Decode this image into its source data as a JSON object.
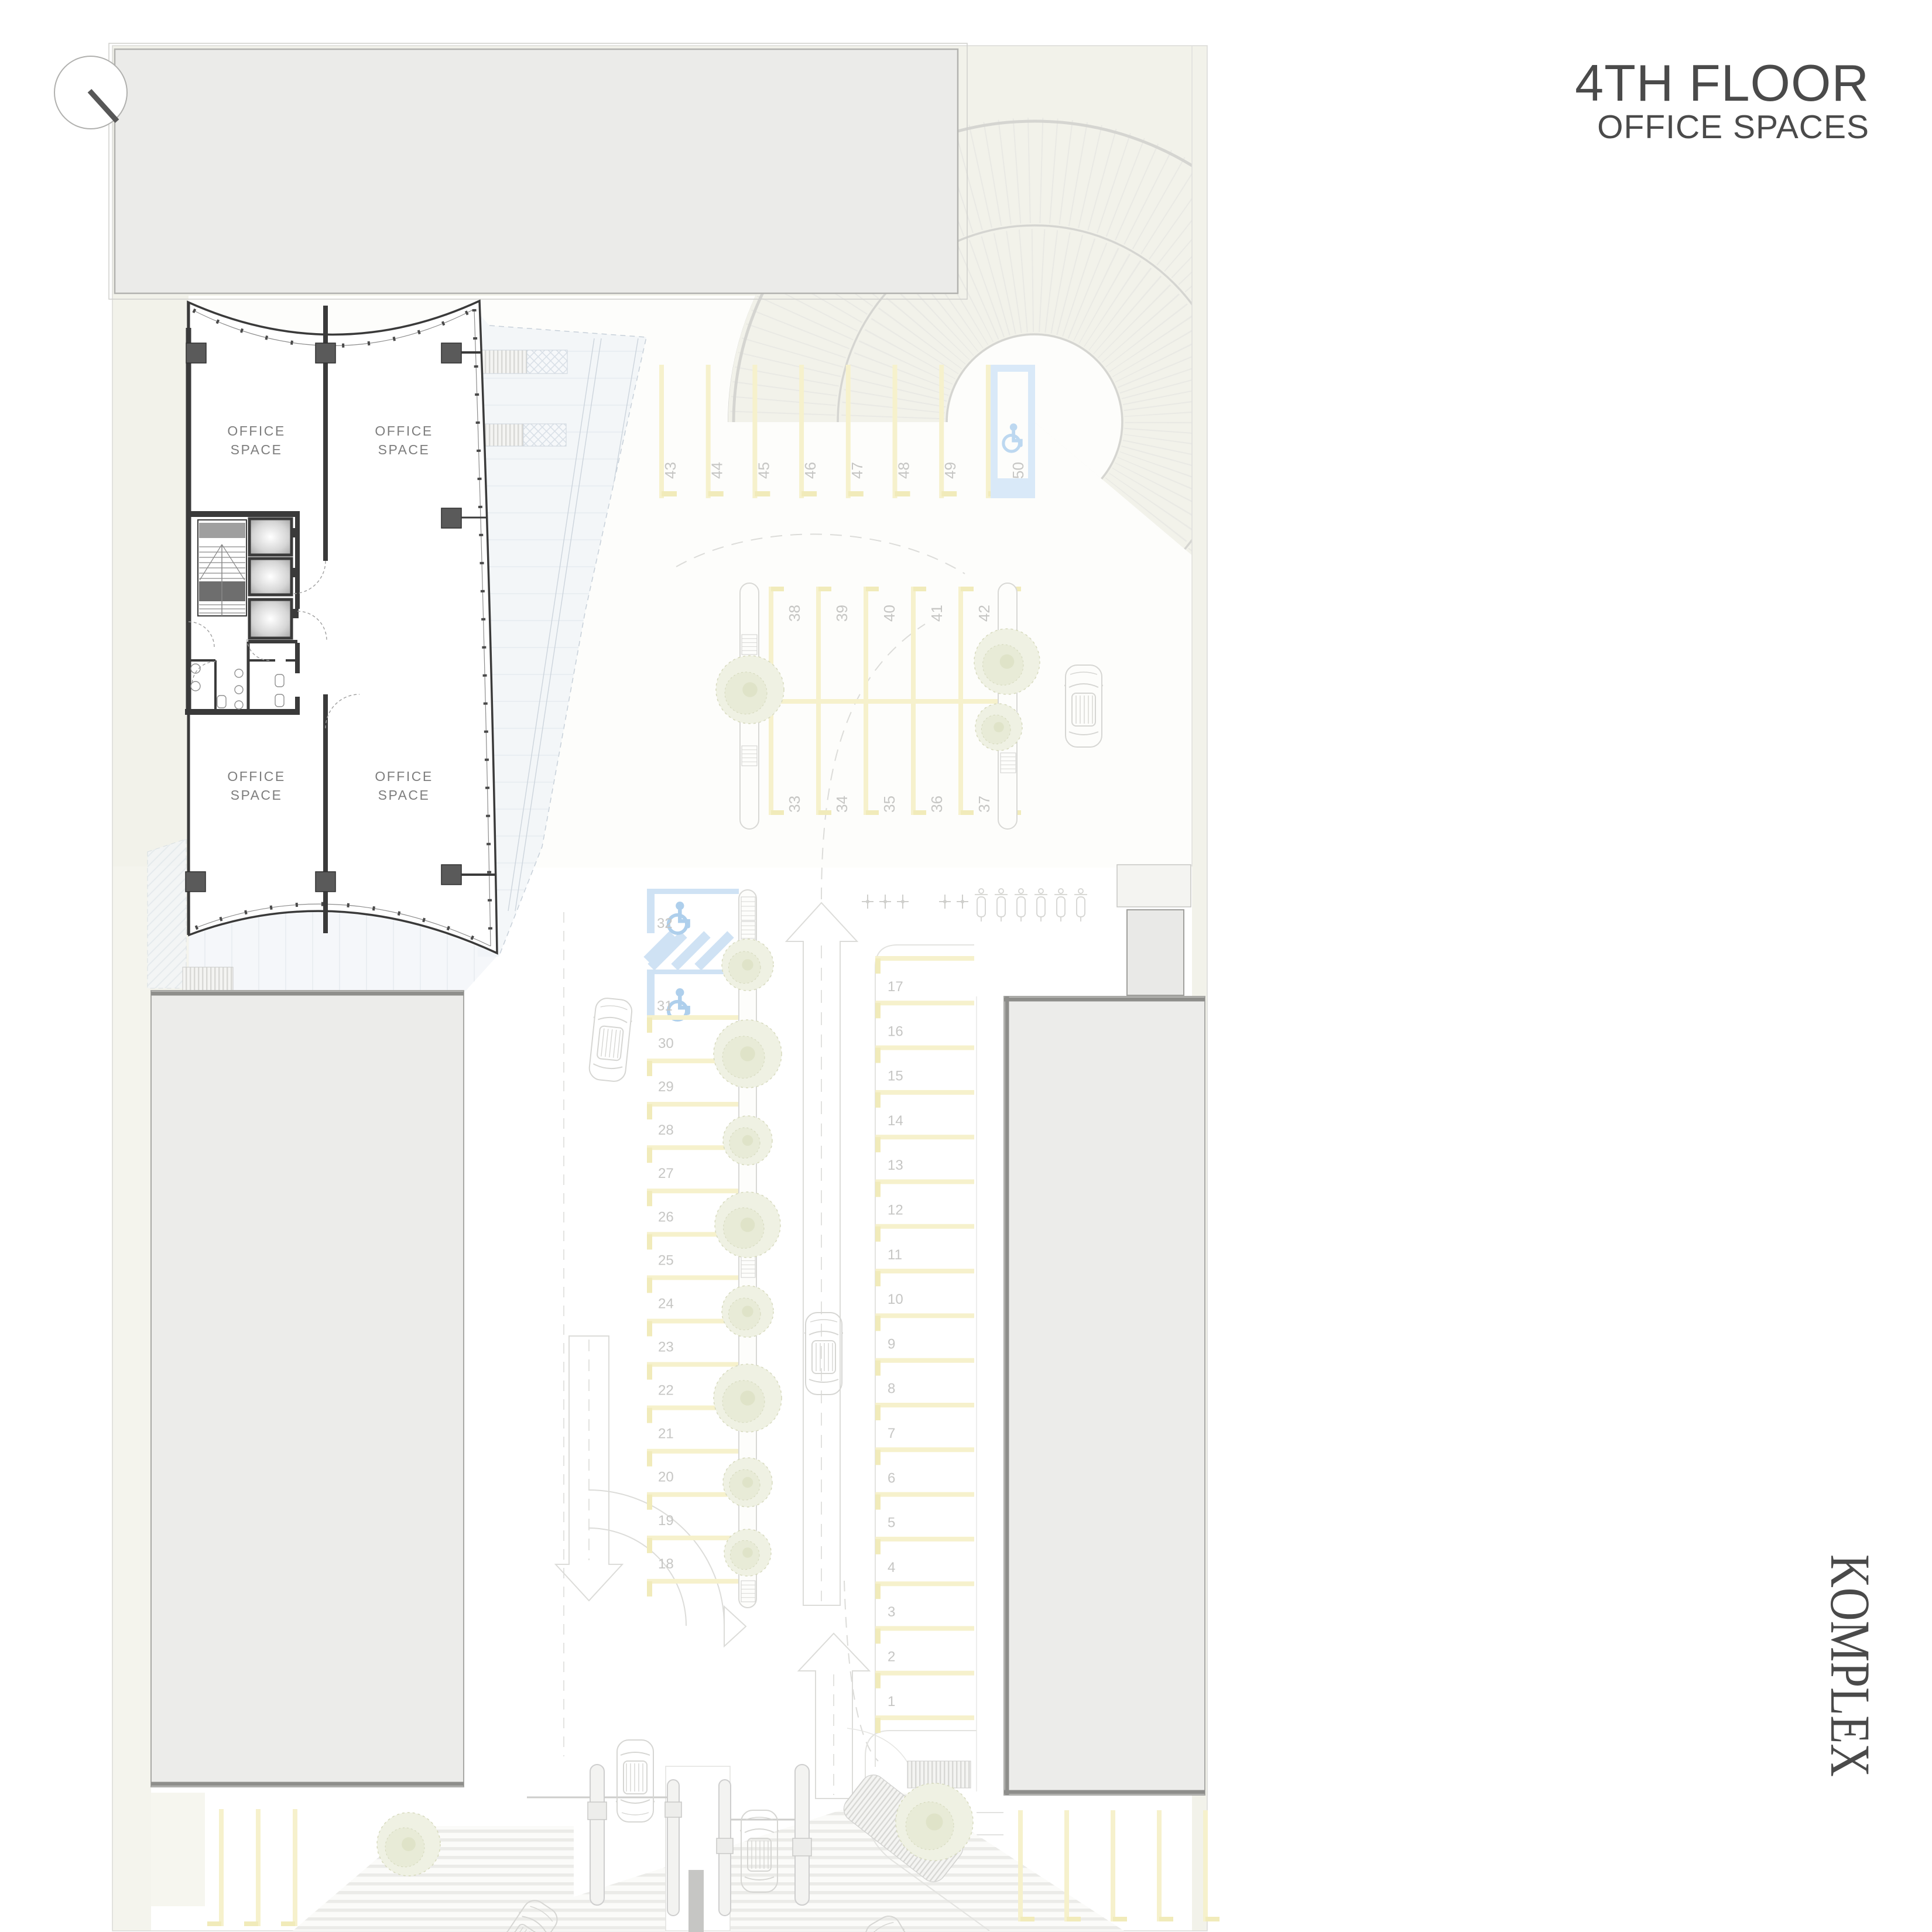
{
  "page_title": {
    "line1": "4TH FLOOR",
    "line2": "OFFICE SPACES"
  },
  "project_label": "KOMPLEX",
  "floor_plan": {
    "rooms": [
      {
        "name": "office-nw",
        "label": [
          "OFFICE",
          "SPACE"
        ]
      },
      {
        "name": "office-ne",
        "label": [
          "OFFICE",
          "SPACE"
        ]
      },
      {
        "name": "office-sw",
        "label": [
          "OFFICE",
          "SPACE"
        ]
      },
      {
        "name": "office-se",
        "label": [
          "OFFICE",
          "SPACE"
        ]
      }
    ]
  },
  "parking": {
    "row_north": {
      "spaces": [
        "43",
        "44",
        "45",
        "46",
        "47",
        "48",
        "49"
      ],
      "accessible_space": "50"
    },
    "row_center_upper": {
      "spaces": [
        "38",
        "39",
        "40",
        "41",
        "42"
      ]
    },
    "row_center_lower": {
      "spaces": [
        "33",
        "34",
        "35",
        "36",
        "37"
      ]
    },
    "column_west": {
      "accessible_spaces": [
        "32",
        "31"
      ],
      "spaces": [
        "30",
        "29",
        "28",
        "27",
        "26",
        "25",
        "24",
        "23",
        "22",
        "21",
        "20",
        "19",
        "18"
      ]
    },
    "column_east": {
      "spaces": [
        "17",
        "16",
        "15",
        "14",
        "13",
        "12",
        "11",
        "10",
        "9",
        "8",
        "7",
        "6",
        "5",
        "4",
        "3",
        "2",
        "1"
      ]
    }
  },
  "colors": {
    "title_text": "#4a4a4a",
    "wall_dark": "#3a3a3a",
    "stall_yellow": "#f6f1cc",
    "accessible_blue": "#cfe2f4",
    "number_text": "#c6c6c4",
    "building_mass": "#ececea",
    "site_paper": "#f2f2ea"
  }
}
